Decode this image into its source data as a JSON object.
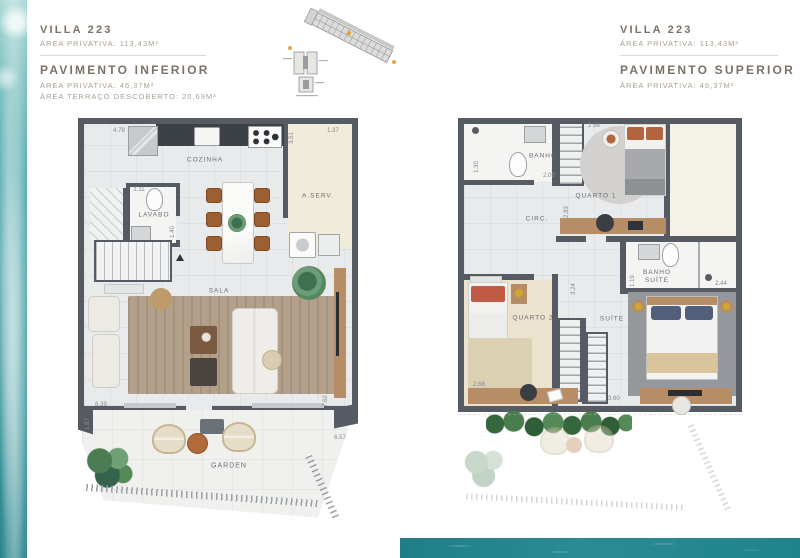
{
  "header_left": {
    "title": "VILLA 223",
    "area_total": "ÁREA PRIVATIVA: 113,43M²",
    "floor": "PAVIMENTO INFERIOR",
    "area_floor": "ÁREA PRIVATIVA: 46,37M²",
    "area_terrace": "ÁREA TERRAÇO DESCOBERTO: 20,69M²"
  },
  "header_right": {
    "title": "VILLA 223",
    "area_total": "ÁREA PRIVATIVA: 113,43M²",
    "floor": "PAVIMENTO SUPERIOR",
    "area_floor": "ÁREA PRIVATIVA: 46,37M²"
  },
  "plan_inferior": {
    "rooms": {
      "cozinha": "COZINHA",
      "aserv": "A.SERV.",
      "lavabo": "LAVABO",
      "sala": "SALA",
      "garden": "GARDEN"
    },
    "dims": {
      "top_left": "4.78",
      "aserv_depth": "3.51",
      "aserv_width": "1.37",
      "lavabo_width": "1.11",
      "lavabo_depth": "1.40",
      "sala_width": "6.39",
      "sala_depth": "7.62",
      "terrace_left": "1.87",
      "terrace_right": "6.57"
    }
  },
  "plan_superior": {
    "rooms": {
      "banho": "BANHO",
      "quarto1": "QUARTO 1",
      "circ": "CIRC.",
      "banho_suite": "BANHO SUÍTE",
      "quarto2": "QUARTO 2",
      "suite": "SUÍTE"
    },
    "dims": {
      "banho_depth": "1.30",
      "banho_width": "2.09",
      "quarto1_top": "2.58",
      "circ_depth": "2.83",
      "banho_suite_depth": "1.19",
      "banho_suite_width": "2.44",
      "hall_depth": "3.24",
      "quarto2_width": "2.68",
      "suite_width": "3.60"
    }
  },
  "colors": {
    "wall": "#565b63",
    "floor": "#e9eaeb",
    "service_floor": "#f1ebda",
    "wood": "#b68d64",
    "plant_green": "#4c7d52",
    "water_teal": "#2e8f96",
    "accent_orange": "#e8a33d",
    "heading_text": "#7b7166"
  }
}
